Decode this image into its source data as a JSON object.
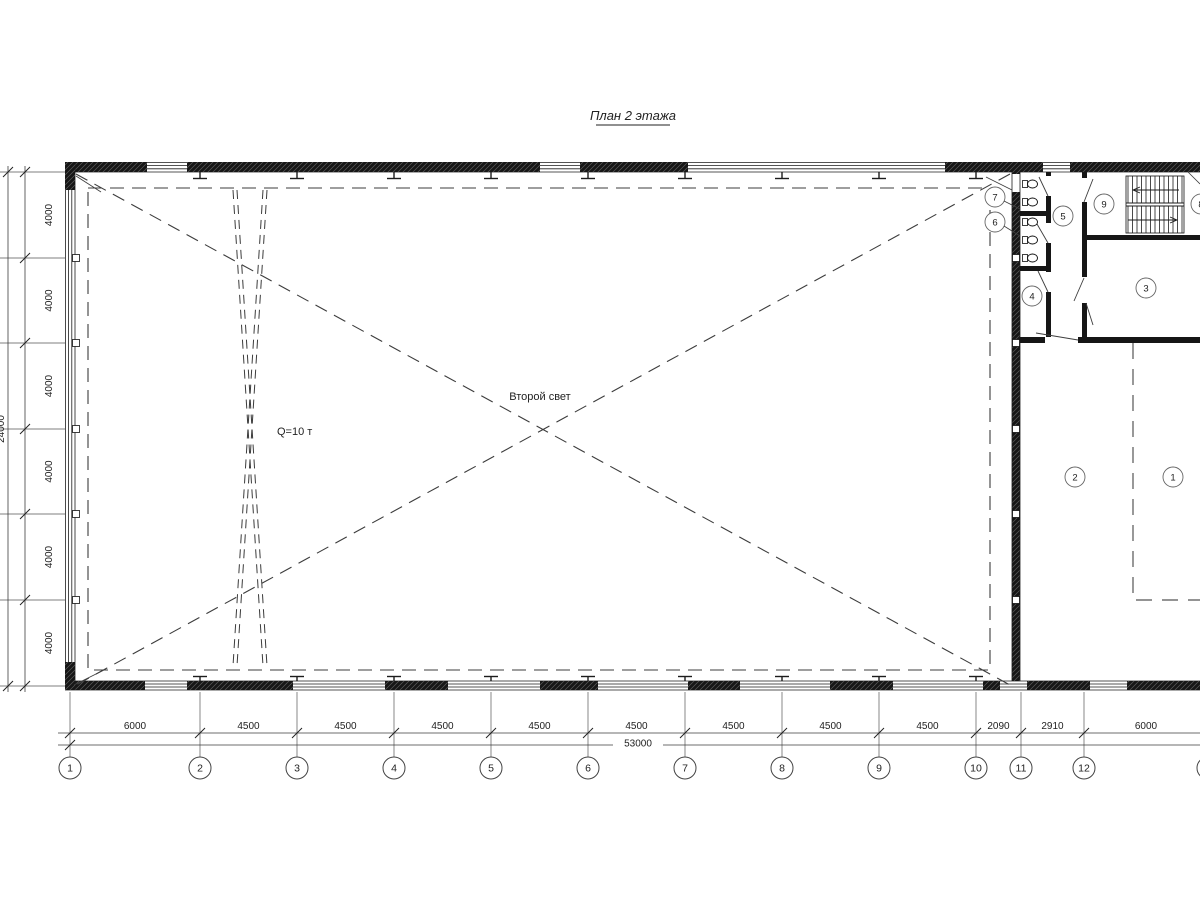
{
  "title": "План 2 этажа",
  "labels": {
    "second_light": "Второй свет",
    "crane_capacity": "Q=10 т"
  },
  "dimensions": {
    "bottom_segments": [
      "6000",
      "4500",
      "4500",
      "4500",
      "4500",
      "4500",
      "4500",
      "4500",
      "4500",
      "2090",
      "2910",
      "6000"
    ],
    "bottom_total": "53000",
    "left_segments": [
      "4000",
      "4000",
      "4000",
      "4000",
      "4000",
      "4000"
    ],
    "left_total": "24000"
  },
  "grid_bubbles": [
    "1",
    "2",
    "3",
    "4",
    "5",
    "6",
    "7",
    "8",
    "9",
    "10",
    "11",
    "12",
    "13"
  ],
  "room_numbers": [
    "7",
    "6",
    "5",
    "9",
    "8",
    "4",
    "3",
    "2",
    "1"
  ],
  "colors": {
    "ink": "#1c1c1c",
    "dim_line": "#3d3d3d",
    "dashed": "#3c3c3c"
  }
}
